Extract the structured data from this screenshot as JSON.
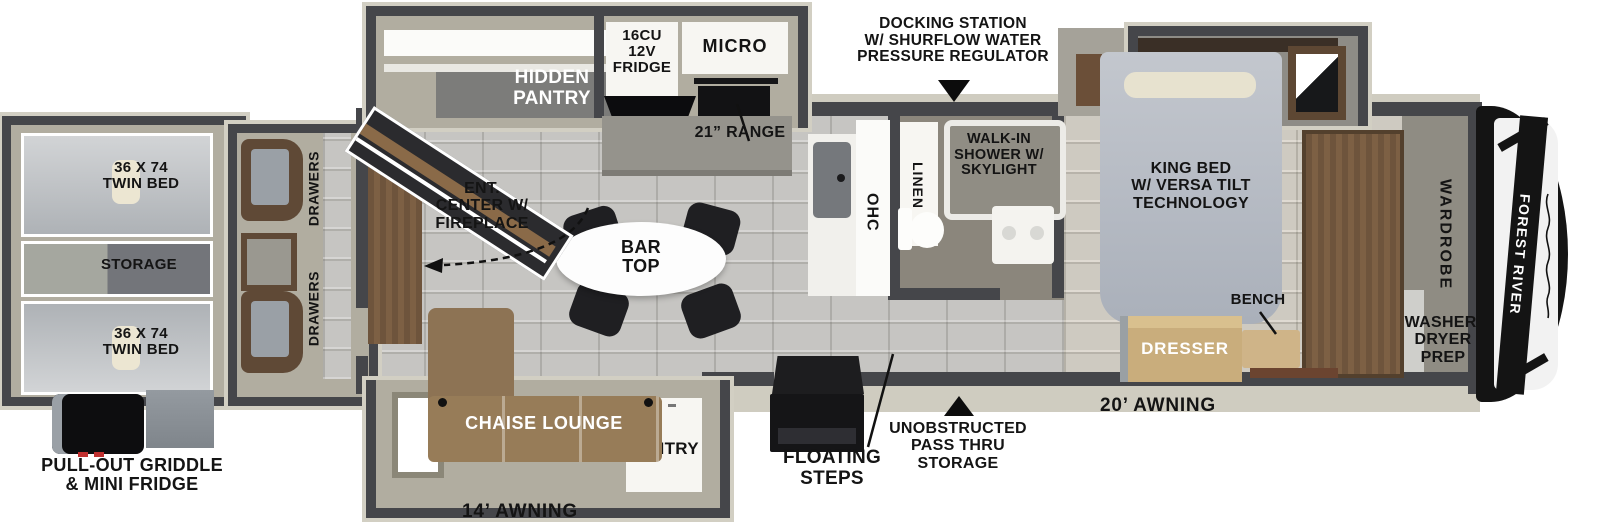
{
  "brand": {
    "name": "FOREST RIVER"
  },
  "exterior": {
    "docking_station": "DOCKING STATION\nW/ SHURFLOW WATER\nPRESSURE REGULATOR",
    "griddle": "PULL-OUT GRIDDLE\n& MINI FRIDGE",
    "awning_front": "20’ AWNING",
    "awning_rear": "14’ AWNING",
    "floating_steps": "FLOATING\nSTEPS",
    "pass_thru": "UNOBSTRUCTED\nPASS THRU\nSTORAGE"
  },
  "bunk_slide": {
    "twin_bed_top": "36 X 74\nTWIN BED",
    "storage": "STORAGE",
    "twin_bed_bottom": "36 X 74\nTWIN BED"
  },
  "bunk_room": {
    "drawers_top": "DRAWERS",
    "drawers_bottom": "DRAWERS"
  },
  "living": {
    "ent_center": "ENT.\nCENTER W/\nFIREPLACE",
    "chaise": "CHAISE LOUNGE"
  },
  "kitchen": {
    "hidden_pantry": "HIDDEN\nPANTRY",
    "fridge": "16CU\n12V\nFRIDGE",
    "micro": "MICRO",
    "range": "21” RANGE",
    "bar_top": "BAR\nTOP",
    "ohc": "OHC",
    "pantry": "PANTRY"
  },
  "bath": {
    "linen": "LINEN",
    "shower": "WALK-IN\nSHOWER W/\nSKYLIGHT"
  },
  "bedroom": {
    "king_bed": "KING BED\nW/ VERSA TILT\nTECHNOLOGY",
    "dresser": "DRESSER",
    "bench": "BENCH"
  },
  "front": {
    "wardrobe": "WARDROBE",
    "washer_dryer": "WASHER/\nDRYER\nPREP"
  },
  "colors": {
    "wall": "#45464a",
    "tile": "#c6c5c2",
    "carpet": "#a9a69c",
    "wood": "#6e543c",
    "sofa": "#977c58",
    "dresser": "#c9ad7c",
    "cap": "#141414",
    "label": "#141414"
  }
}
